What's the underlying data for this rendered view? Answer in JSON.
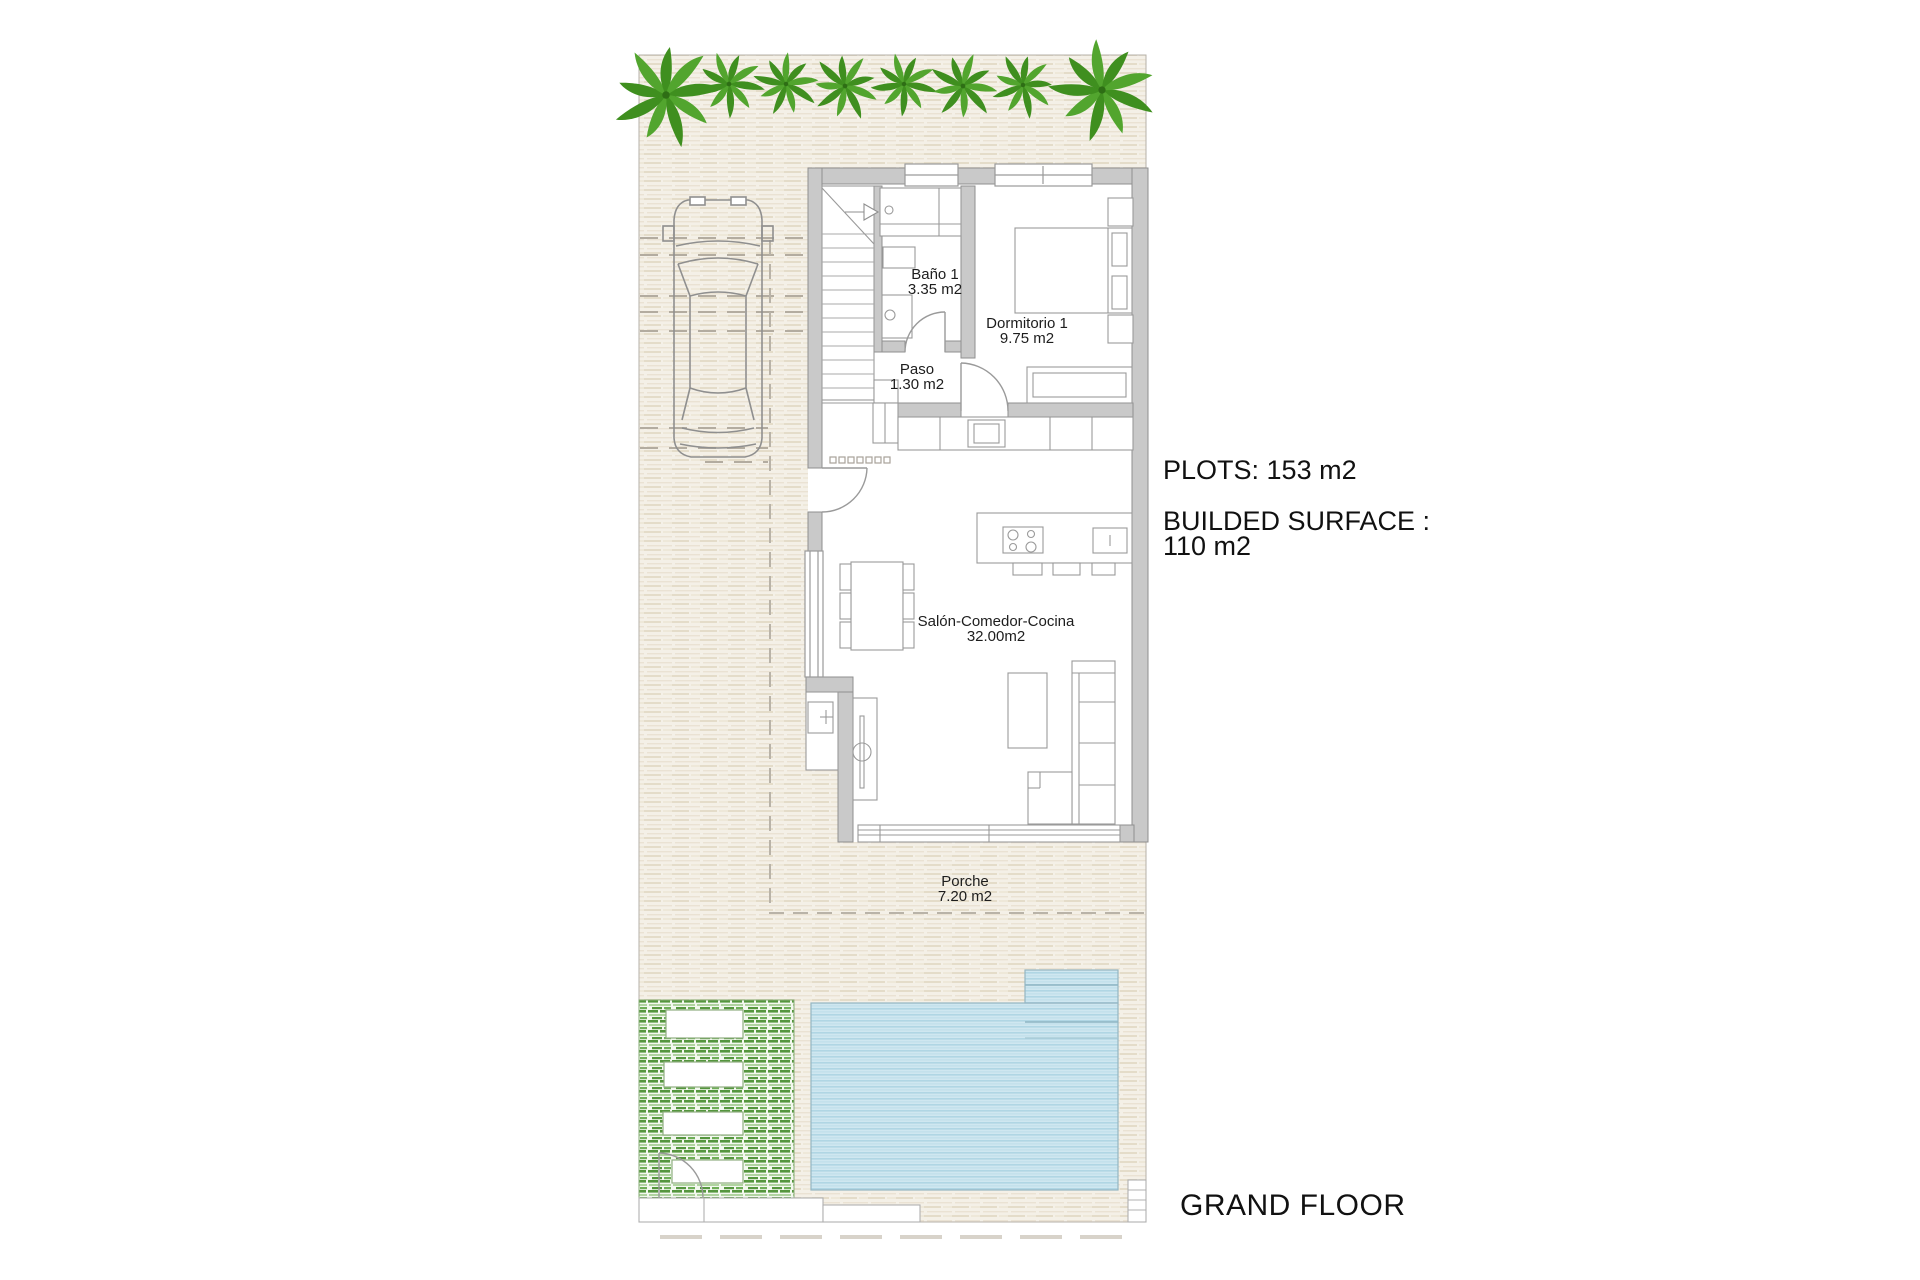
{
  "rooms": [
    {
      "name": "Baño 1",
      "area": "3.35 m2"
    },
    {
      "name": "Dormitorio 1",
      "area": "9.75 m2"
    },
    {
      "name": "Paso",
      "area": "1.30 m2"
    },
    {
      "name": "Salón-Comedor-Cocina",
      "area": "32.00m2"
    },
    {
      "name": "Porche",
      "area": "7.20 m2"
    }
  ],
  "summary": {
    "plots": "PLOTS: 153 m2",
    "builded_surface_line1": "BUILDED SURFACE :",
    "builded_surface_line2": "110 m2"
  },
  "floor_label": "GRAND FLOOR",
  "colors": {
    "paving_base": "#f4f0e7",
    "paving_stripe": "#e2d8c5",
    "wall_fill": "#c9c9c9",
    "wall_stroke": "#8f8f8f",
    "palm_green": "#3f8f1f",
    "palm_green_light": "#52a52e",
    "garden_green": "#55963e",
    "pool_blue": "#cfe7f0",
    "pool_stripe": "#b0d6e4",
    "dash_line": "#b3aca0",
    "text": "#1d1d1d"
  }
}
